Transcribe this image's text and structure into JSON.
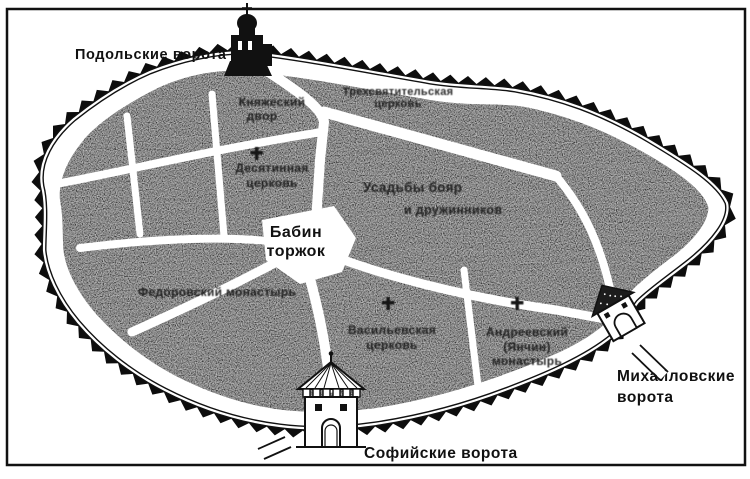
{
  "figure": {
    "kind": "scanned historical city plan (ancient Kyiv, city of Vladimir)",
    "colors": {
      "ink": "#111111",
      "block_fill": "#4a4a4a",
      "paper": "#ffffff"
    }
  },
  "gates": [
    {
      "id": "podolsk",
      "label": "Подольские ворота"
    },
    {
      "id": "mikhailov",
      "label_lines": [
        "Михайловские",
        "ворота"
      ]
    },
    {
      "id": "sofia",
      "label": "Софийские ворота"
    }
  ],
  "center_square": {
    "label_lines": [
      "Бабин",
      "торжок"
    ]
  },
  "district_labels": [
    {
      "lines": [
        "Княжеский",
        "двор"
      ],
      "legible": false
    },
    {
      "lines": [
        "Десятинная",
        "церковь"
      ],
      "legible": false,
      "symbol": "church-cross"
    },
    {
      "lines": [
        "Трехсвятительская",
        "церковь"
      ],
      "legible": false
    },
    {
      "lines": [
        "Федоровский монастырь"
      ],
      "legible": false
    },
    {
      "lines": [
        "Усадьбы бояр",
        "и дружинников"
      ],
      "legible": false
    },
    {
      "lines": [
        "Васильевская",
        "церковь"
      ],
      "legible": false,
      "symbol": "church-cross"
    },
    {
      "lines": [
        "Андреевский",
        "(Янчин)",
        "монастырь"
      ],
      "legible": false,
      "symbol": "church-cross"
    }
  ]
}
